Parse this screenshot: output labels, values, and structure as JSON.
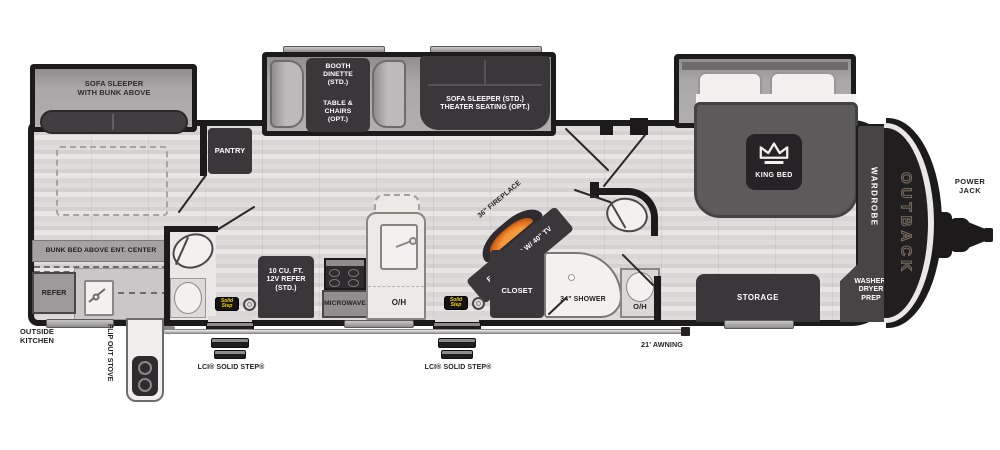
{
  "front_room": {
    "slide_label": "SOFA SLEEPER\nWITH BUNK ABOVE",
    "bunk_label": "BUNK BED ABOVE ENT. CENTER",
    "refer_label": "REFER",
    "outside_kitchen_label": "OUTSIDE\nKITCHEN",
    "flip_out_stove_label": "FLIP OUT STOVE",
    "pantry_label": "PANTRY"
  },
  "dinette_slide": {
    "dinette_std_label": "BOOTH\nDINETTE\n(STD.)",
    "dinette_opt_label": "TABLE &\nCHAIRS\n(OPT.)",
    "sofa_label": "SOFA SLEEPER (STD.)\nTHEATER SEATING (OPT.)"
  },
  "kitchen": {
    "refer_label": "10 CU. FT.\n12V REFER\n(STD.)",
    "microwave_label": "MICROWAVE",
    "overhead_label": "O/H"
  },
  "living": {
    "fireplace_label": "36\" FIREPLACE",
    "ent_center_label": "ENT. CENTER W/ 40\" TV"
  },
  "bathroom": {
    "closet_label": "CLOSET",
    "shower_label": "34\" SHOWER",
    "overhead_label": "O/H"
  },
  "bedroom": {
    "king_bed_label": "KING BED",
    "wardrobe_label": "WARDROBE",
    "storage_label": "STORAGE",
    "washer_dryer_label": "WASHER/\nDRYER\nPREP"
  },
  "exterior": {
    "brand_label": "OUTBACK",
    "power_jack_label": "POWER\nJACK",
    "awning_label": "21' AWNING",
    "step_label": "LCI® SOLID STEP®",
    "solid_step_badge": "Solid\nStep"
  },
  "colors": {
    "wall": "#1c1a1b",
    "furniture_dark": "#3a373b",
    "slide_gray": "#a8a6a7",
    "floor_light": "#d8d7d6",
    "fixture_white": "#f2f1ef",
    "flame_orange": "#e87d28",
    "badge_yellow": "#f5d400"
  }
}
